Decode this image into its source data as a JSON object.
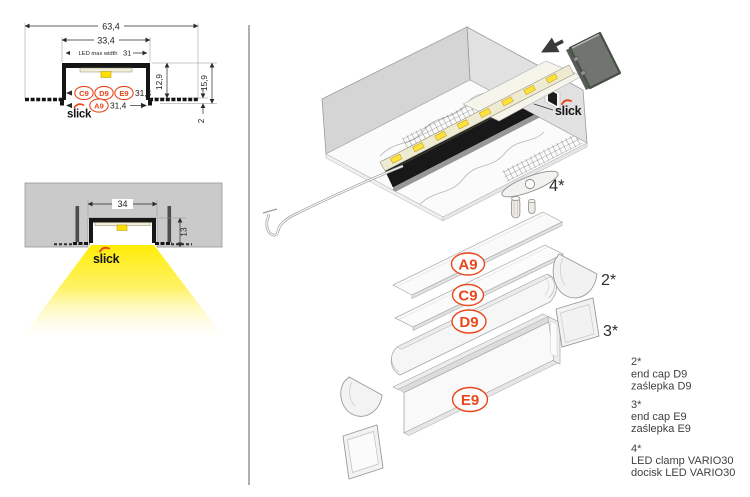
{
  "brand": {
    "name": "slick",
    "accent_color": "#e8481c"
  },
  "colors": {
    "accent": "#e8481c",
    "profile_black": "#161616",
    "ceiling_gray": "#cacaca",
    "box_gray": "#d5d5d5",
    "light_yellow": "#ffec00",
    "endcap_gray": "#70756f",
    "legend_text": "#3f3f3f"
  },
  "cross_section": {
    "dims": {
      "overall_width": "63,4",
      "inner_width": "33,4",
      "led_max_width_label": "LED max width",
      "led_max_width_value": "31",
      "inner_depth": "12,9",
      "overall_depth": "15,9",
      "flange_thickness": "2",
      "cover_row_top": "31,4",
      "cover_row_bottom": "31,4"
    },
    "covers": {
      "c9": "C9",
      "d9": "D9",
      "e9": "E9",
      "a9": "A9"
    }
  },
  "installed_view": {
    "dims": {
      "opening_width": "34",
      "recess_depth": "13"
    }
  },
  "assembly": {
    "clamp_callout": "4*"
  },
  "stack": {
    "covers": [
      "A9",
      "C9",
      "D9",
      "E9"
    ],
    "endcap_d9_callout": "2*",
    "endcap_e9_callout": "3*"
  },
  "legend": {
    "items": [
      {
        "ref": "2*",
        "name_en": "end cap D9",
        "name_pl": "zaślepka D9"
      },
      {
        "ref": "3*",
        "name_en": "end cap E9",
        "name_pl": "zaślepka E9"
      },
      {
        "ref": "4*",
        "name_en": "LED clamp VARIO30",
        "name_pl": "docisk LED VARIO30"
      }
    ]
  }
}
